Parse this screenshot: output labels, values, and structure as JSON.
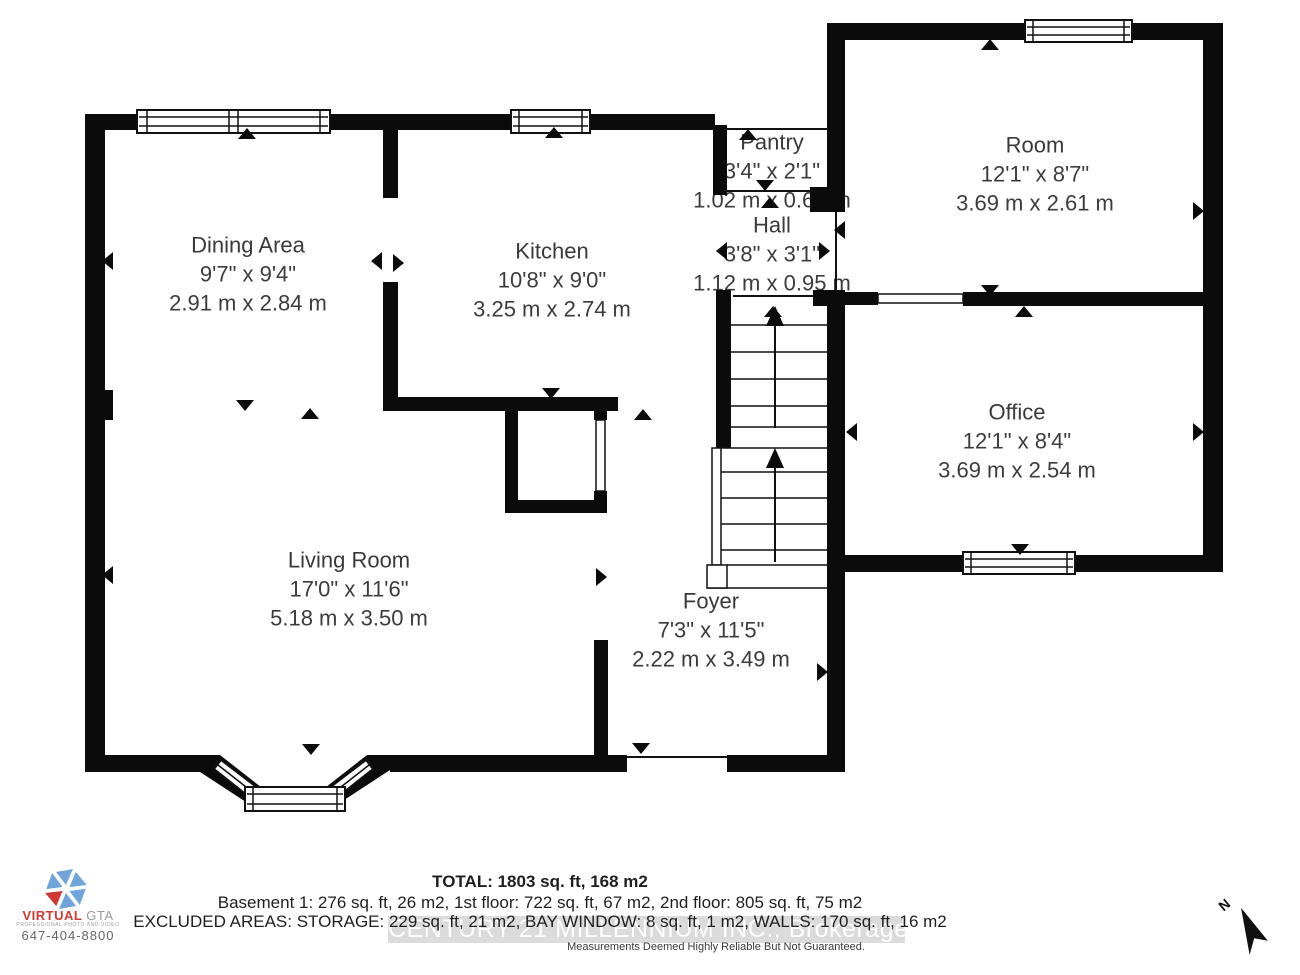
{
  "plan": {
    "wall_color": "#0b0b0b",
    "text_color": "#3c3c3c",
    "rooms": [
      {
        "id": "dining",
        "name": "Dining Area",
        "imperial": "9'7\" x 9'4\"",
        "metric": "2.91 m x 2.84 m"
      },
      {
        "id": "kitchen",
        "name": "Kitchen",
        "imperial": "10'8\" x 9'0\"",
        "metric": "3.25 m x 2.74 m"
      },
      {
        "id": "pantry",
        "name": "Pantry",
        "imperial": "3'4\" x 2'1\"",
        "metric": "1.02 m x 0.65 m"
      },
      {
        "id": "hall",
        "name": "Hall",
        "imperial": "3'8\" x 3'1\"",
        "metric": "1.12 m x 0.95 m"
      },
      {
        "id": "room",
        "name": "Room",
        "imperial": "12'1\" x 8'7\"",
        "metric": "3.69 m x 2.61 m"
      },
      {
        "id": "office",
        "name": "Office",
        "imperial": "12'1\" x 8'4\"",
        "metric": "3.69 m x 2.54 m"
      },
      {
        "id": "living",
        "name": "Living Room",
        "imperial": "17'0\" x 11'6\"",
        "metric": "5.18 m x 3.50 m"
      },
      {
        "id": "foyer",
        "name": "Foyer",
        "imperial": "7'3\" x 11'5\"",
        "metric": "2.22 m x 3.49 m"
      }
    ]
  },
  "summary": {
    "total": "TOTAL: 1803 sq. ft, 168 m2",
    "floors": "Basement 1: 276 sq. ft, 26 m2, 1st floor: 722 sq. ft, 67 m2, 2nd floor: 805 sq. ft, 75 m2",
    "excluded": "EXCLUDED AREAS: STORAGE: 229 sq. ft, 21 m2, BAY WINDOW: 8 sq. ft, 1 m2, WALLS: 170 sq. ft, 16 m2",
    "disclaimer": "Measurements Deemed Highly Reliable But Not Guaranteed."
  },
  "watermark": "CENTURY 21 MILLENNIUM INC., Brokerage",
  "logo": {
    "brand_primary": "VIRTUAL",
    "brand_secondary": "GTA",
    "tagline": "PROFESSIONAL PHOTO AND VIDEO",
    "phone": "647-404-8800",
    "accent_red": "#cf3a32",
    "accent_blue": "#6fa5d8"
  },
  "compass": {
    "label": "N"
  }
}
